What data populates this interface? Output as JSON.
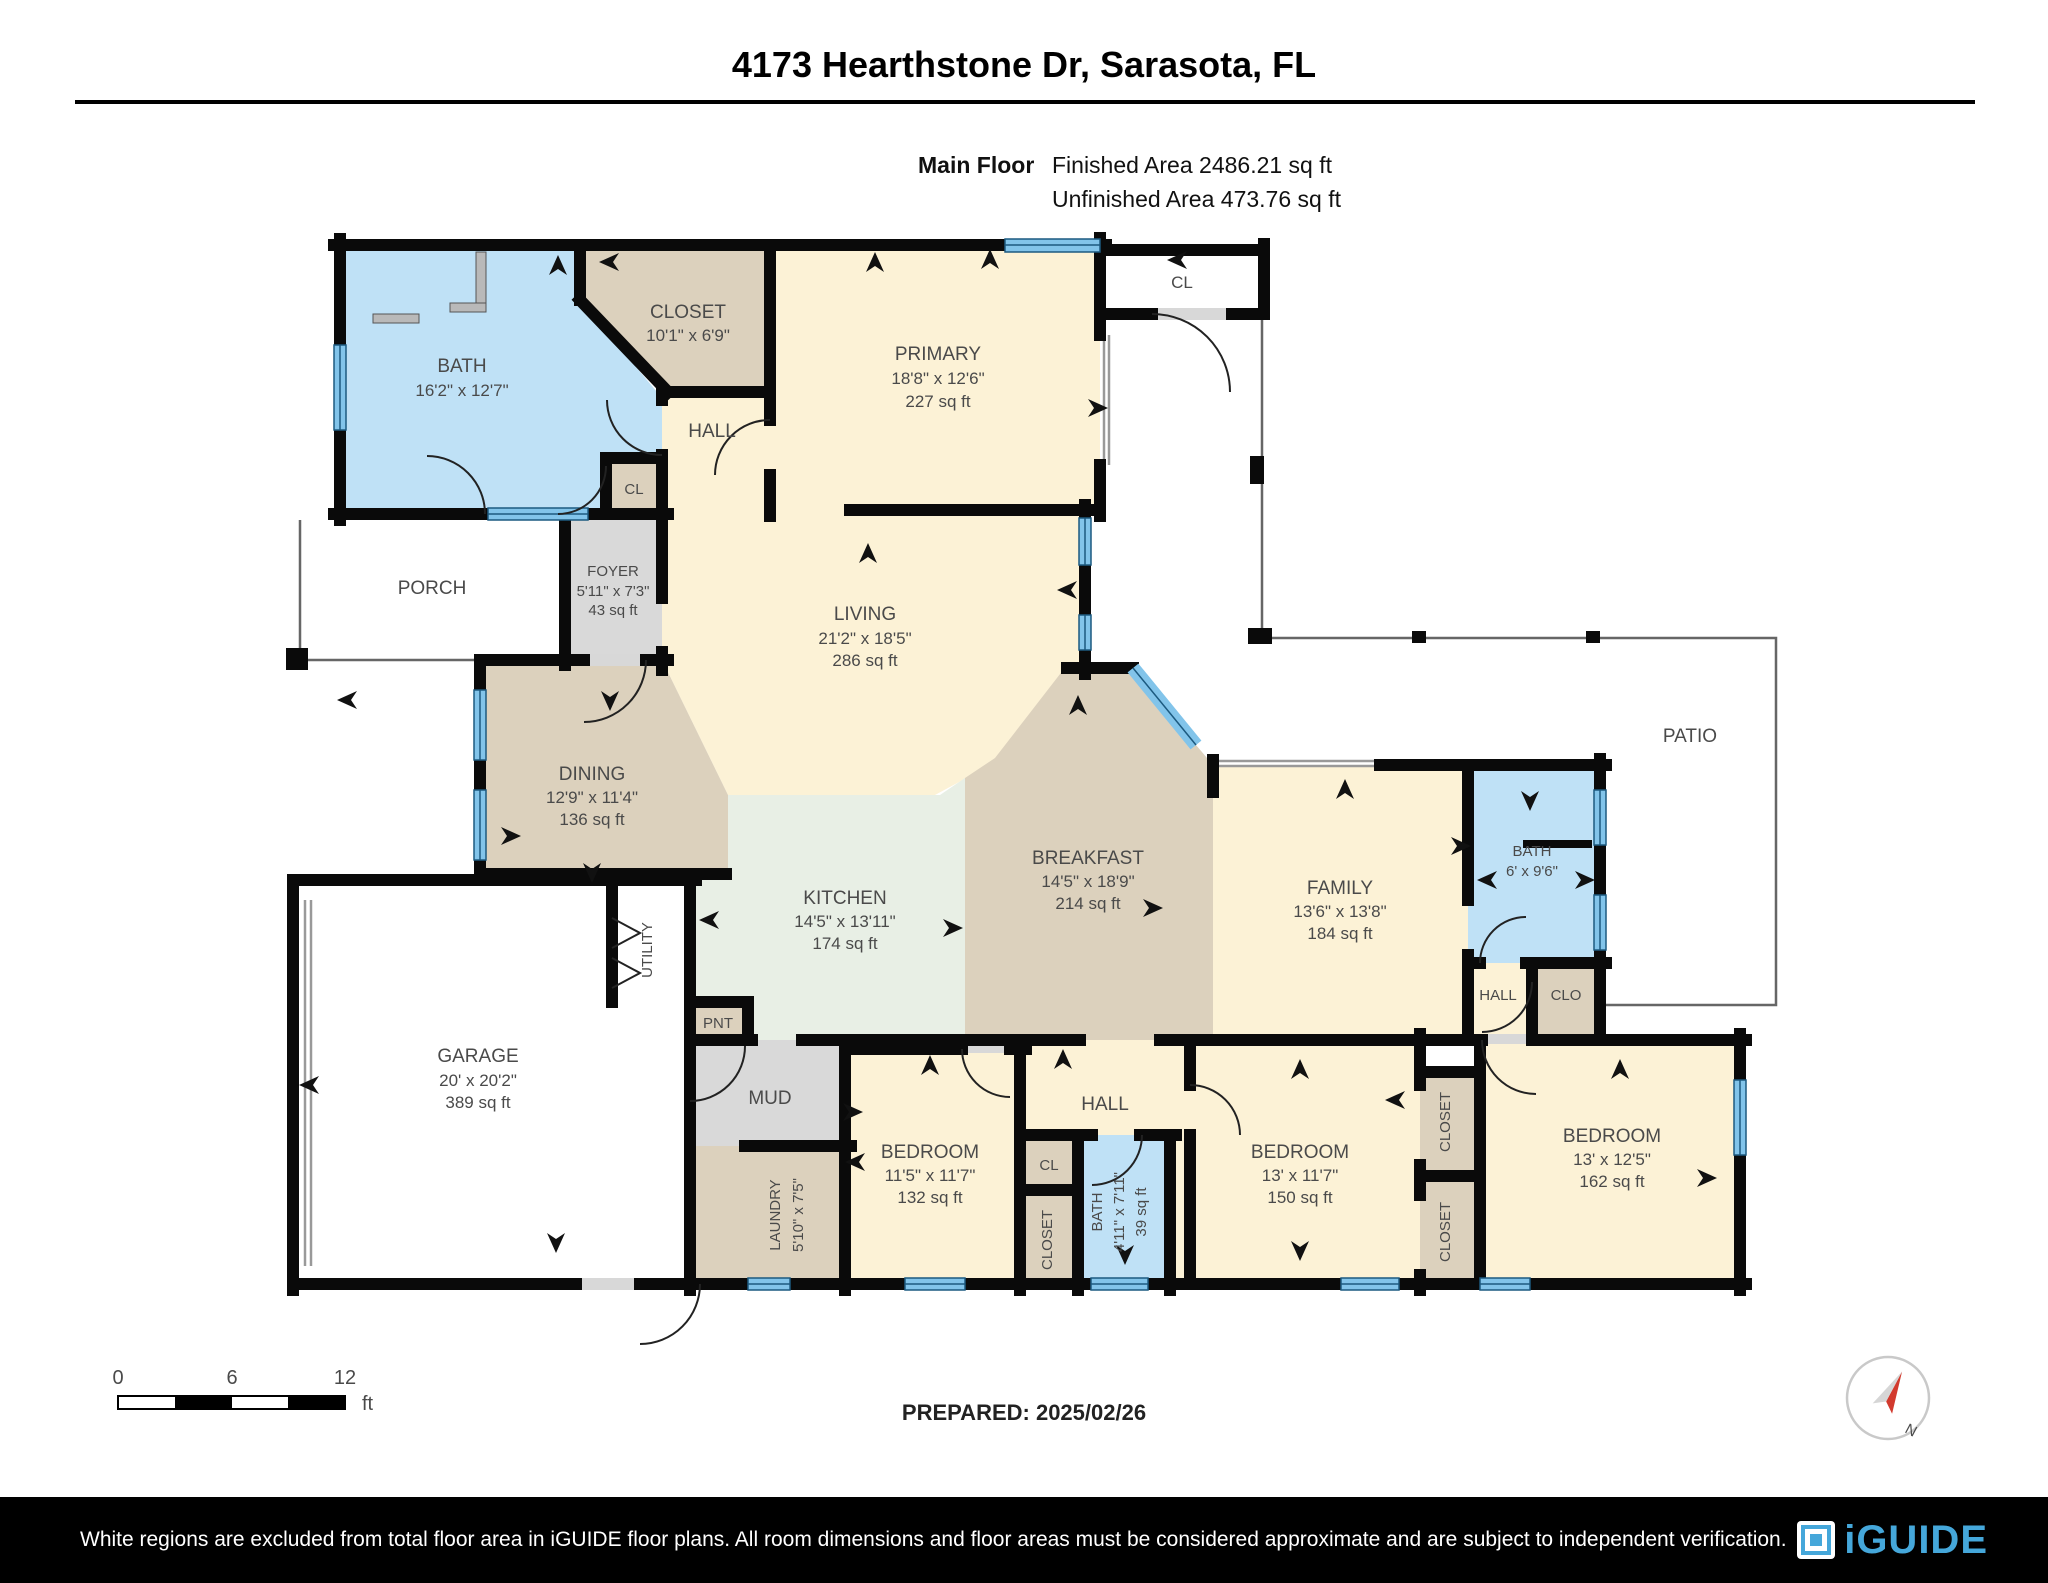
{
  "header": {
    "title": "4173 Hearthstone Dr, Sarasota, FL",
    "floor_label": "Main Floor",
    "finished_area": "Finished Area 2486.21 sq ft",
    "unfinished_area": "Unfinished Area 473.76 sq ft"
  },
  "rooms": {
    "bath1": {
      "name": "BATH",
      "dims": "16'2\" x 12'7\""
    },
    "closet1": {
      "name": "CLOSET",
      "dims": "10'1\" x 6'9\""
    },
    "primary": {
      "name": "PRIMARY",
      "dims": "18'8\" x 12'6\"",
      "area": "227 sq ft"
    },
    "cl1": {
      "name": "CL"
    },
    "hall1": {
      "name": "HALL"
    },
    "cl2": {
      "name": "CL"
    },
    "porch": {
      "name": "PORCH"
    },
    "foyer": {
      "name": "FOYER",
      "dims": "5'11\" x 7'3\"",
      "area": "43 sq ft"
    },
    "living": {
      "name": "LIVING",
      "dims": "21'2\" x 18'5\"",
      "area": "286 sq ft"
    },
    "dining": {
      "name": "DINING",
      "dims": "12'9\" x 11'4\"",
      "area": "136 sq ft"
    },
    "kitchen": {
      "name": "KITCHEN",
      "dims": "14'5\" x 13'11\"",
      "area": "174 sq ft"
    },
    "breakfast": {
      "name": "BREAKFAST",
      "dims": "14'5\" x 18'9\"",
      "area": "214 sq ft"
    },
    "family": {
      "name": "FAMILY",
      "dims": "13'6\" x 13'8\"",
      "area": "184 sq ft"
    },
    "bath2": {
      "name": "BATH",
      "dims": "6' x 9'6\""
    },
    "hall3": {
      "name": "HALL"
    },
    "clo": {
      "name": "CLO"
    },
    "patio": {
      "name": "PATIO"
    },
    "garage": {
      "name": "GARAGE",
      "dims": "20' x 20'2\"",
      "area": "389 sq ft"
    },
    "utility": {
      "name": "UTILITY"
    },
    "pnt": {
      "name": "PNT"
    },
    "mud": {
      "name": "MUD"
    },
    "laundry": {
      "name": "LAUNDRY",
      "dims": "5'10\" x 7'5\""
    },
    "bedroom1": {
      "name": "BEDROOM",
      "dims": "11'5\" x 11'7\"",
      "area": "132 sq ft"
    },
    "hall2": {
      "name": "HALL"
    },
    "cl3": {
      "name": "CL"
    },
    "closet2": {
      "name": "CLOSET"
    },
    "bath3": {
      "name": "BATH",
      "dims": "4'11\" x 7'11\"",
      "area": "39 sq ft"
    },
    "bedroom2": {
      "name": "BEDROOM",
      "dims": "13' x 11'7\"",
      "area": "150 sq ft"
    },
    "closet3": {
      "name": "CLOSET"
    },
    "closet4": {
      "name": "CLOSET"
    },
    "bedroom3": {
      "name": "BEDROOM",
      "dims": "13' x 12'5\"",
      "area": "162 sq ft"
    }
  },
  "scale_bar": {
    "t0": "0",
    "t6": "6",
    "t12": "12",
    "unit": "ft"
  },
  "compass": {
    "north_label": "N"
  },
  "footer": {
    "prepared": "PREPARED: 2025/02/26",
    "disclaimer": "White regions are excluded from total floor area in iGUIDE floor plans. All room dimensions and floor areas must be considered approximate and are subject to independent verification.",
    "logo_text": "iGUIDE"
  },
  "colors": {
    "room_cream": "#fcf2d6",
    "room_tan": "#dcd1bd",
    "room_blue": "#bfe1f6",
    "room_gray": "#dcdcdc",
    "room_green": "#e8efe5",
    "wall": "#0a0a0a",
    "window_light": "#82c4ea",
    "window_dark": "#1c5a80",
    "logo_blue": "#45a7da"
  }
}
